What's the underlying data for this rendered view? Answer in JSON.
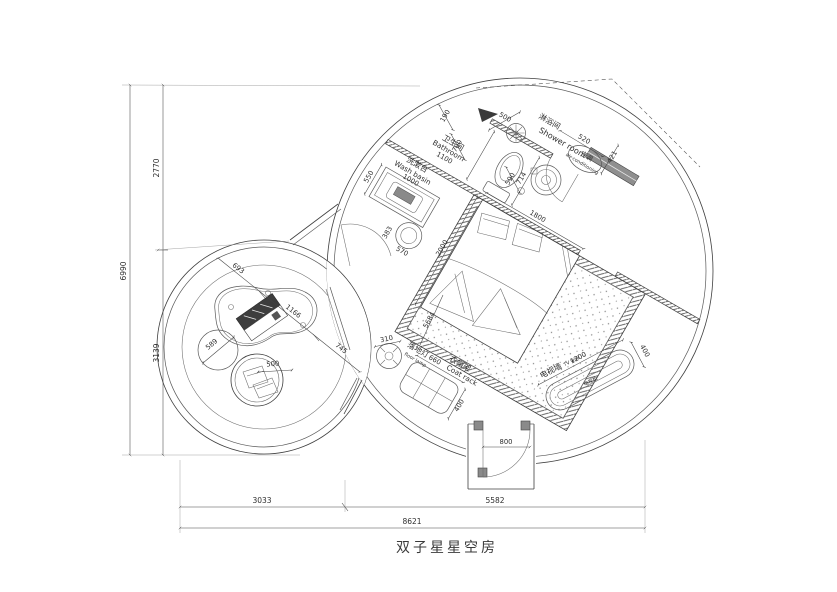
{
  "title": "双子星星空房",
  "labels": {
    "bathroom_cn": "卫生间",
    "bathroom_en": "Bathroom",
    "washbasin_cn": "洗漱台",
    "washbasin_en": "Wash basin",
    "shower_cn": "淋浴间",
    "shower_en": "Shower room",
    "ac_cn": "空调",
    "ac_en": "air-conditioning",
    "tv_wall_cn": "电视墙",
    "tv_wall_en": "TV wall",
    "tv_cabinet_cn": "电视柜",
    "floor_lamp_cn": "落地灯",
    "floor_lamp_en": "floor lamp",
    "coat_rack_cn": "衣帽架",
    "coat_rack_en": "Coat rack"
  },
  "dims": {
    "overall_h": "6990",
    "upper_h": "2770",
    "lower_h": "3139",
    "left_w": "3033",
    "right_w": "5582",
    "overall_w": "8621",
    "bath_190": "190",
    "bath_700": "700",
    "door_500": "500",
    "gap_590": "590",
    "bath_1100": "1100",
    "basin_1000": "1000",
    "counter_550": "550",
    "toilet_714": "714",
    "bed_w": "1800",
    "bed_l": "2000",
    "stool_383": "383",
    "stool_570": "570",
    "diag_5684": "5684",
    "bench_520": "520",
    "ac_421": "421",
    "lamp_310": "310",
    "rack_660": "660",
    "rack_400": "400",
    "entry_800": "800",
    "tv_1200": "1200",
    "tv_400": "400",
    "table_693": "693",
    "table_1166": "1166",
    "pass_745": "745",
    "pouf_589": "589",
    "nest_500": "500"
  }
}
